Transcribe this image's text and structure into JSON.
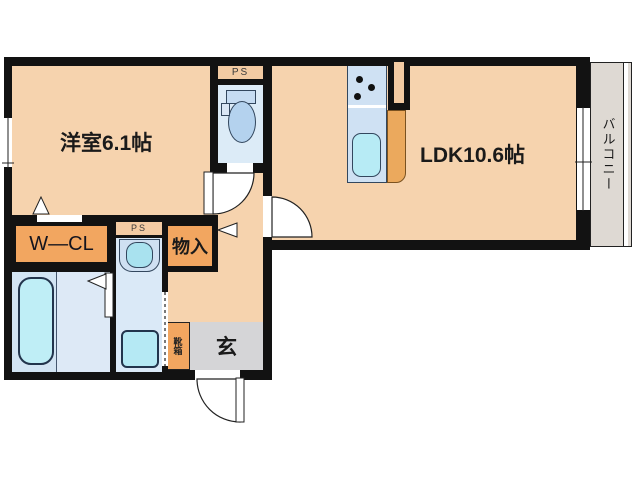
{
  "floorplan": {
    "rooms": {
      "western_room": {
        "label": "洋室6.1帖"
      },
      "ldk": {
        "label": "LDK10.6帖"
      },
      "walk_in_closet": {
        "label": "W—CL"
      },
      "storage": {
        "label": "物入"
      },
      "entrance": {
        "label": "玄"
      },
      "shoe_box": {
        "label": "靴箱"
      },
      "balcony": {
        "label": "バルコニー"
      },
      "pipe_space_toilet": {
        "label": "PS"
      },
      "pipe_space_washroom": {
        "label": "PS"
      }
    },
    "colors": {
      "floor_peach": "#f6d3ae",
      "closet_orange": "#f2a660",
      "pipe_space_tan": "#f3cba3",
      "water_room_blue": "#dcebf7",
      "fixture_cyan": "#b6ebf5",
      "kitchen_counter_orange": "#eba95d",
      "entrance_gray": "#d5d5d7",
      "balcony_gray": "#ded9d3",
      "wall_black": "#121212"
    }
  }
}
